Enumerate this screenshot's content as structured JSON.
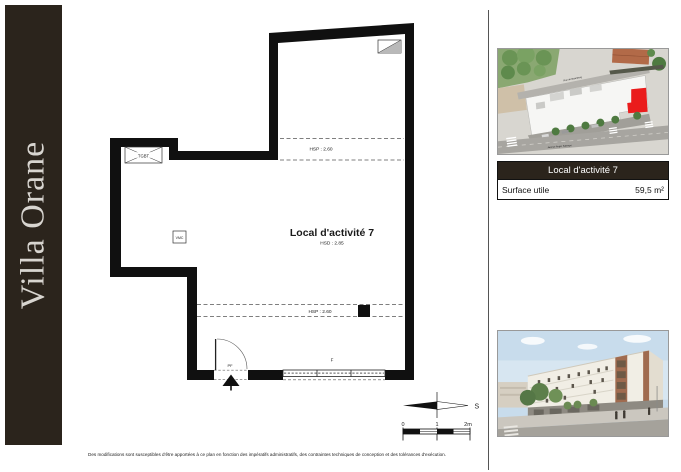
{
  "banner": {
    "title": "Villa Orane",
    "bg_color": "#2b241c",
    "text_color": "#d8d5d0"
  },
  "plan": {
    "room_title": "Local d'activité 7",
    "room_height_label": "HSD : 2.85",
    "ceiling_zone_upper": "HSP : 2.60",
    "ceiling_zone_lower": "HSP : 2.60",
    "labels": {
      "electrical_box": "TGBT",
      "ventilation": "VMC",
      "door": "PF",
      "window": "F"
    }
  },
  "compass": {
    "south": "S"
  },
  "scale_bar": {
    "tick_0": "0",
    "tick_1": "1",
    "tick_2": "2m"
  },
  "sidebar": {
    "site_plan": {
      "street_top": "Rue de Gutenberg",
      "street_bottom": "Avenue Roger Salengro",
      "highlight_color": "#ea1c1c"
    },
    "info_table": {
      "header": "Local d'activité 7",
      "row_label": "Surface utile",
      "row_value": "59,5 m²"
    }
  },
  "footer": {
    "disclaimer": "Des modifications sont susceptibles d'être apportées à ce plan en fonction des impératifs administratifs, des contraintes techniques de conception et des tolérances d'exécution."
  }
}
